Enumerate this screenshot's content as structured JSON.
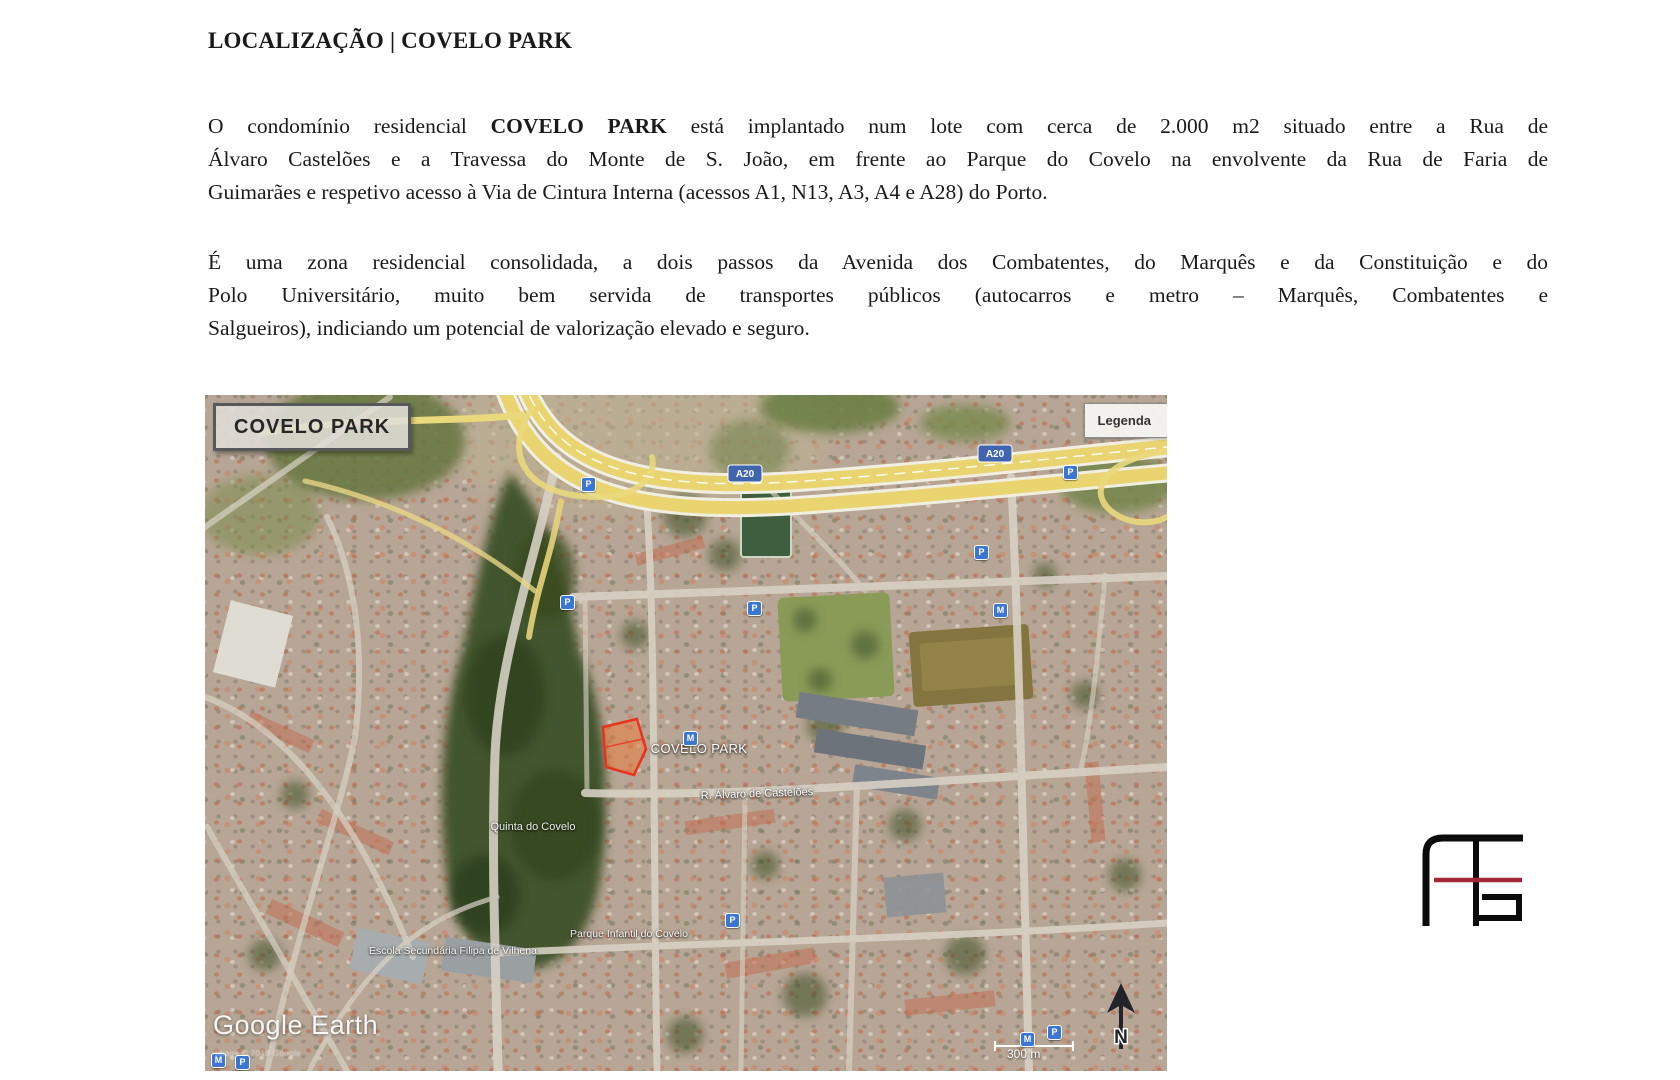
{
  "document": {
    "title": "LOCALIZAÇÃO | COVELO PARK",
    "p1": {
      "l1_before": "O condomínio residencial ",
      "l1_bold": "COVELO PARK",
      "l1_after": " está implantado num lote com cerca de 2.000 m2 situado entre a Rua de",
      "l2": "Álvaro Castelões e a Travessa do Monte de S. João, em frente ao Parque do Covelo na envolvente da Rua de Faria de",
      "l3": "Guimarães e respetivo acesso à Via de Cintura Interna (acessos A1, N13, A3, A4 e A28) do Porto."
    },
    "p2": {
      "l1": "É uma zona residencial consolidada, a dois passos da Avenida dos Combatentes, do Marquês e da Constituição e do",
      "l2": "Polo Universitário, muito bem servida de transportes públicos  (autocarros e metro – Marquês, Combatentes e",
      "l3": "Salgueiros),  indiciando um potencial de valorização elevado e seguro."
    }
  },
  "map": {
    "overlay_title": "COVELO PARK",
    "legend_button": "Legenda",
    "site_label": "COVELO PARK",
    "labels": {
      "street": "R. Álvaro de Castelões",
      "park": "Quinta do Covelo",
      "playground": "Parque Infantil do Covelo",
      "school": "Escola Secundária Filipa de Vilhena"
    },
    "highway_shield": "A20",
    "watermark": "Google Earth",
    "attribution": "Image © 2018 Google",
    "scale_label": "300 m",
    "north_label": "N",
    "icons": {
      "parking": "P",
      "metro": "M"
    }
  },
  "branding": {
    "logo_name": "AE monogram",
    "ink_color": "#0b0b0b",
    "accent_red": "#a62639"
  }
}
